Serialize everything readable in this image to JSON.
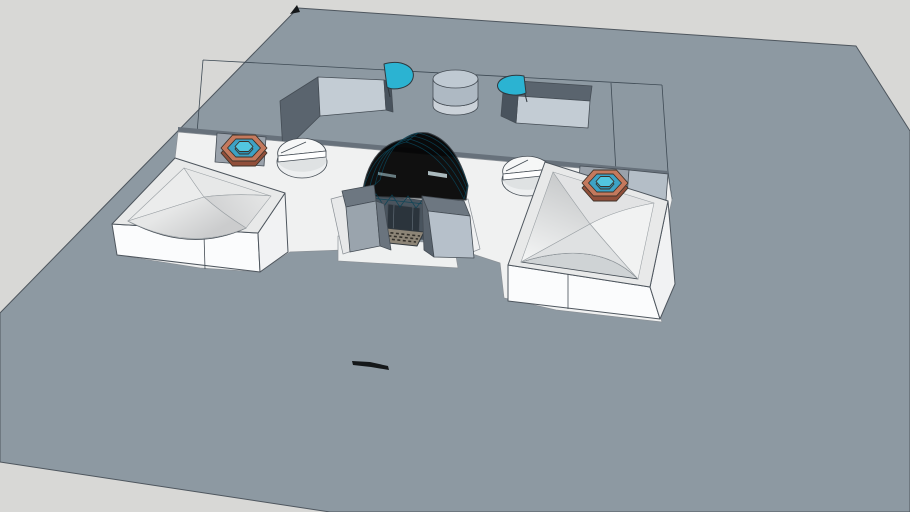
{
  "viewport": {
    "width": 910,
    "height": 512
  },
  "scene": {
    "objects": [
      "sky-background",
      "ground-plane",
      "footprint-marking-lines",
      "deck-step",
      "sunken-courtyard-left",
      "sunken-courtyard-right",
      "skylight-half-dome-left",
      "skylight-half-dome-right",
      "roof-drum-skylight",
      "white-plaza",
      "entrance-apron",
      "entrance-vault-canopy",
      "entrance-doorway",
      "entrance-grate",
      "vault-abutment-left",
      "vault-abutment-right",
      "pavilion-left",
      "pavilion-right",
      "wedge-cylinder-left",
      "wedge-cylinder-right",
      "fountain-left",
      "fountain-right",
      "scale-marker",
      "corner-marker"
    ]
  },
  "colors": {
    "background": "#d8d8d6",
    "terrain": "#8d99a2",
    "step_face": "#67717b",
    "pit_wall_shadow": "#5a646e",
    "pit_wall_dark": "#49535d",
    "pit_wall_lit": "#c3ccd4",
    "dome_teal": "#2bb3d2",
    "drum_top": "#bfc9d2",
    "drum_upper": "#aeb9c3",
    "drum_lower": "#cbd2d9",
    "plaza_white": "#f0f1f1",
    "apron_white": "#eef0f0",
    "parapet_left": "#e7e8e9",
    "parapet_right": "#f0f1f2",
    "pad_gray": "#9aa2ab",
    "panel_light": "#b4bec7",
    "block_top": "#6d7781",
    "block_front_left": "#9aa4ad",
    "block_side_dark": "#6a747e",
    "block_front_lit": "#b6c0ca",
    "block_side_shadow": "#59636d",
    "interior_dark": "#49545e",
    "door_dark": "#2b343c",
    "grate_base": "#8d8577",
    "vault_light": "#31bedd",
    "vault_dark": "#1391b4",
    "vault_reflection_bright": "#dff3f8",
    "vault_reflection_soft": "#bfe8f2",
    "wall_bright": "#fbfcfd",
    "wall_shaded": "#f1f2f3",
    "rim_top": "#e8e9e9",
    "crescent_left": "#d8dbdc",
    "crescent_right": "#cfd3d5",
    "roofL_nw": "#ebecec",
    "roofL_ne": "#e7e8e8",
    "roofL_se_from": "#e6e7e7",
    "roofL_se_to": "#d0d1d2",
    "roofL_sw_from": "#cbcccd",
    "roofL_sw_to": "#e6e7e7",
    "roofR_nw_from": "#c9cbcc",
    "roofR_nw_to": "#f4f5f5",
    "roofR_ne": "#e2e3e4",
    "roofR_se": "#f1f2f2",
    "roofR_sw": "#dfe1e2",
    "wedge_base": "#edeff0",
    "wedge_raised": "#f6f7f7",
    "wedge_lip": "#ffffff",
    "wedge_shadow": "#dfe2e3",
    "fountain_rim_side": "#914f3a",
    "fountain_rim_top": "#c4795d",
    "fountain_water": "#3da2c5",
    "fountain_island_side": "#2b93b5",
    "fountain_island_top": "#52c6e0",
    "marker_black": "#15181a"
  }
}
